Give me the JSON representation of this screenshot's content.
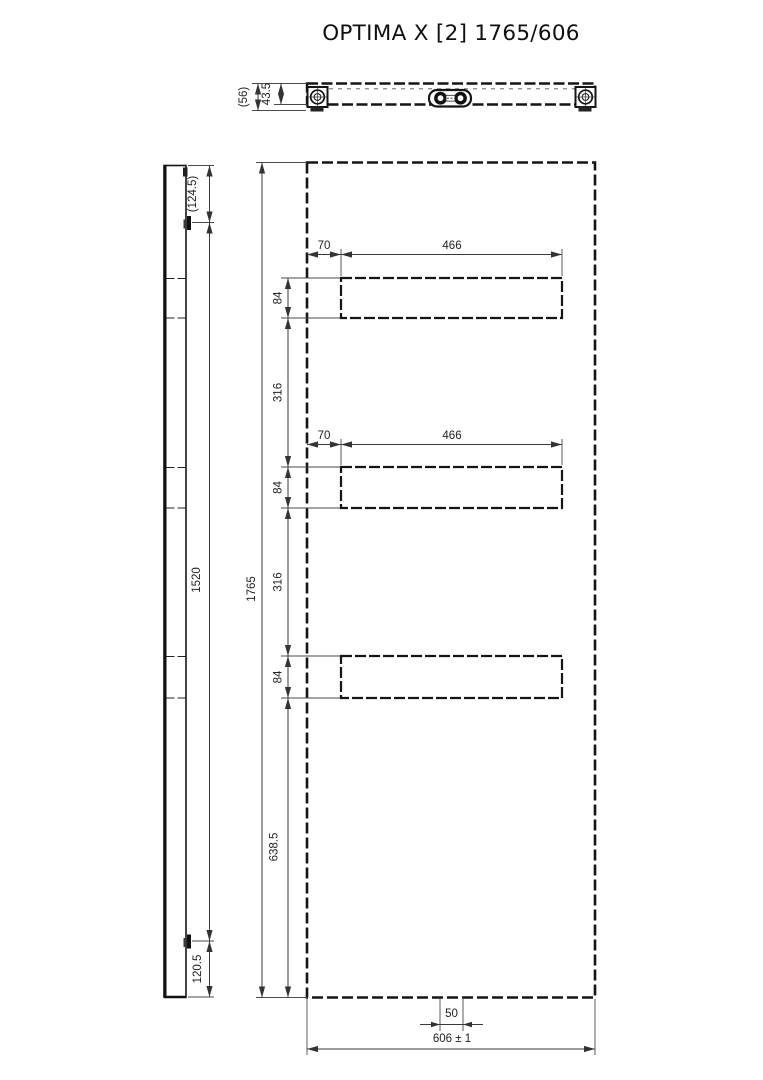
{
  "title": "OPTIMA X [2] 1765/606",
  "top_view": {
    "depth_overall": "(56)",
    "depth_body": "43.5"
  },
  "side_view": {
    "bracket_top_offset": "(124.5)",
    "bracket_spacing": "1520",
    "bracket_bottom_offset": "120.5"
  },
  "front_view": {
    "height": "1765",
    "width": "606 ± 1",
    "notch_width": "50",
    "bottom_to_slot": "638.5",
    "gap12": "316",
    "gap23": "316",
    "slot1": {
      "offset": "70",
      "width": "466",
      "height": "84"
    },
    "slot2": {
      "offset": "70",
      "width": "466",
      "height": "84"
    },
    "slot3": {
      "height": "84"
    }
  }
}
